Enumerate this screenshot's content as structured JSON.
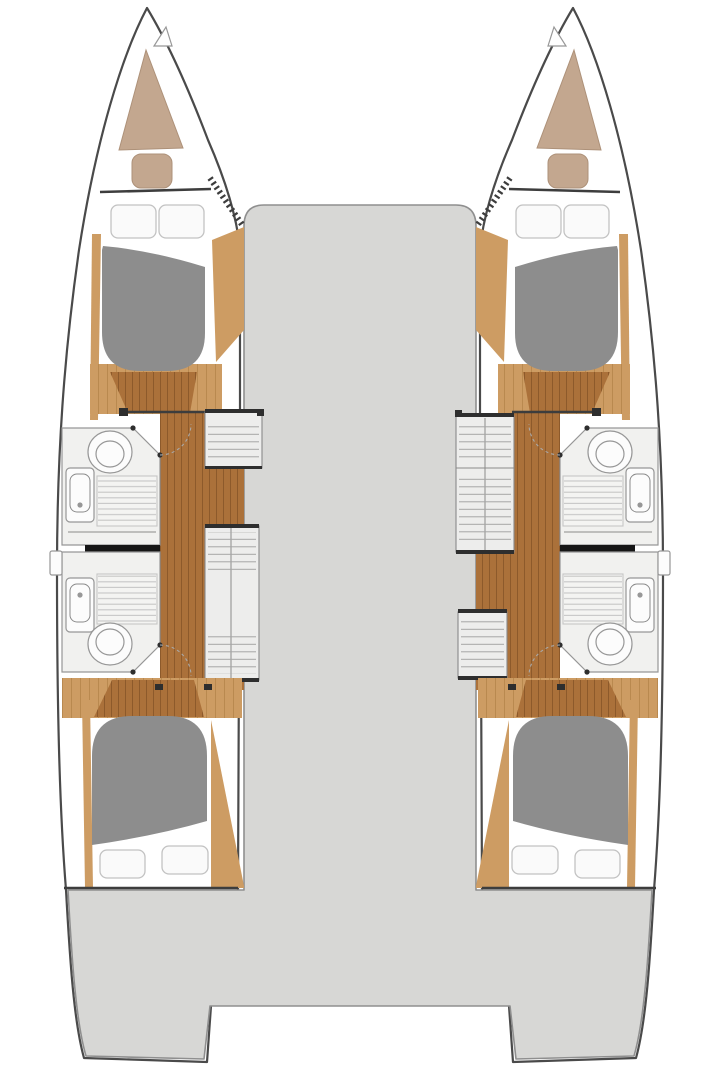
{
  "plan": {
    "type": "catamaran-floor-plan",
    "layout": "4-cabin-4-head",
    "deck_areas": [
      "bridge-deck",
      "stern-cockpit",
      "port-transom-step",
      "starboard-transom-step"
    ],
    "hulls": [
      {
        "side": "port",
        "rooms": [
          "bow-locker",
          "forward-cabin",
          "forward-head",
          "aft-head",
          "aft-cabin"
        ],
        "features": [
          "bow-cushion",
          "double-berth-forward",
          "double-berth-aft",
          "toilet",
          "sink",
          "shower",
          "companionway-steps",
          "wardrobe",
          "corridor",
          "porthole"
        ]
      },
      {
        "side": "starboard",
        "rooms": [
          "bow-locker",
          "forward-cabin",
          "forward-head",
          "aft-head",
          "aft-cabin"
        ],
        "features": [
          "bow-cushion",
          "double-berth-forward",
          "double-berth-aft",
          "toilet",
          "sink",
          "shower",
          "companionway-steps",
          "wardrobe",
          "corridor",
          "porthole"
        ]
      }
    ]
  },
  "colors": {
    "white": "#ffffff",
    "outline": "#4a4a4a",
    "deck": "#d7d7d5",
    "deck_line": "#8f8f8f",
    "bed": "#8d8d8d",
    "pillow": "#fafafa",
    "pillow_line": "#c2c2c2",
    "wood_dark": "#ab713a",
    "wood_light": "#cd9c63",
    "plank_dark": "#8d5a2b",
    "plank_light": "#b9894f",
    "bow_locker": "#c3a78f",
    "bow_locker_line": "#ad9179",
    "bath": "#f1f1ef",
    "fixture": "#fcfcfc",
    "fixture_line": "#979797",
    "slat": "#c6c6c6",
    "unit": "#ededec",
    "unit_line": "#8a8a8a",
    "hatch": "#a5a5a5",
    "cap": "#2e2e2e",
    "partition": "#161616",
    "wall": "#3d3d3d",
    "arc": "#a9a9a9"
  }
}
